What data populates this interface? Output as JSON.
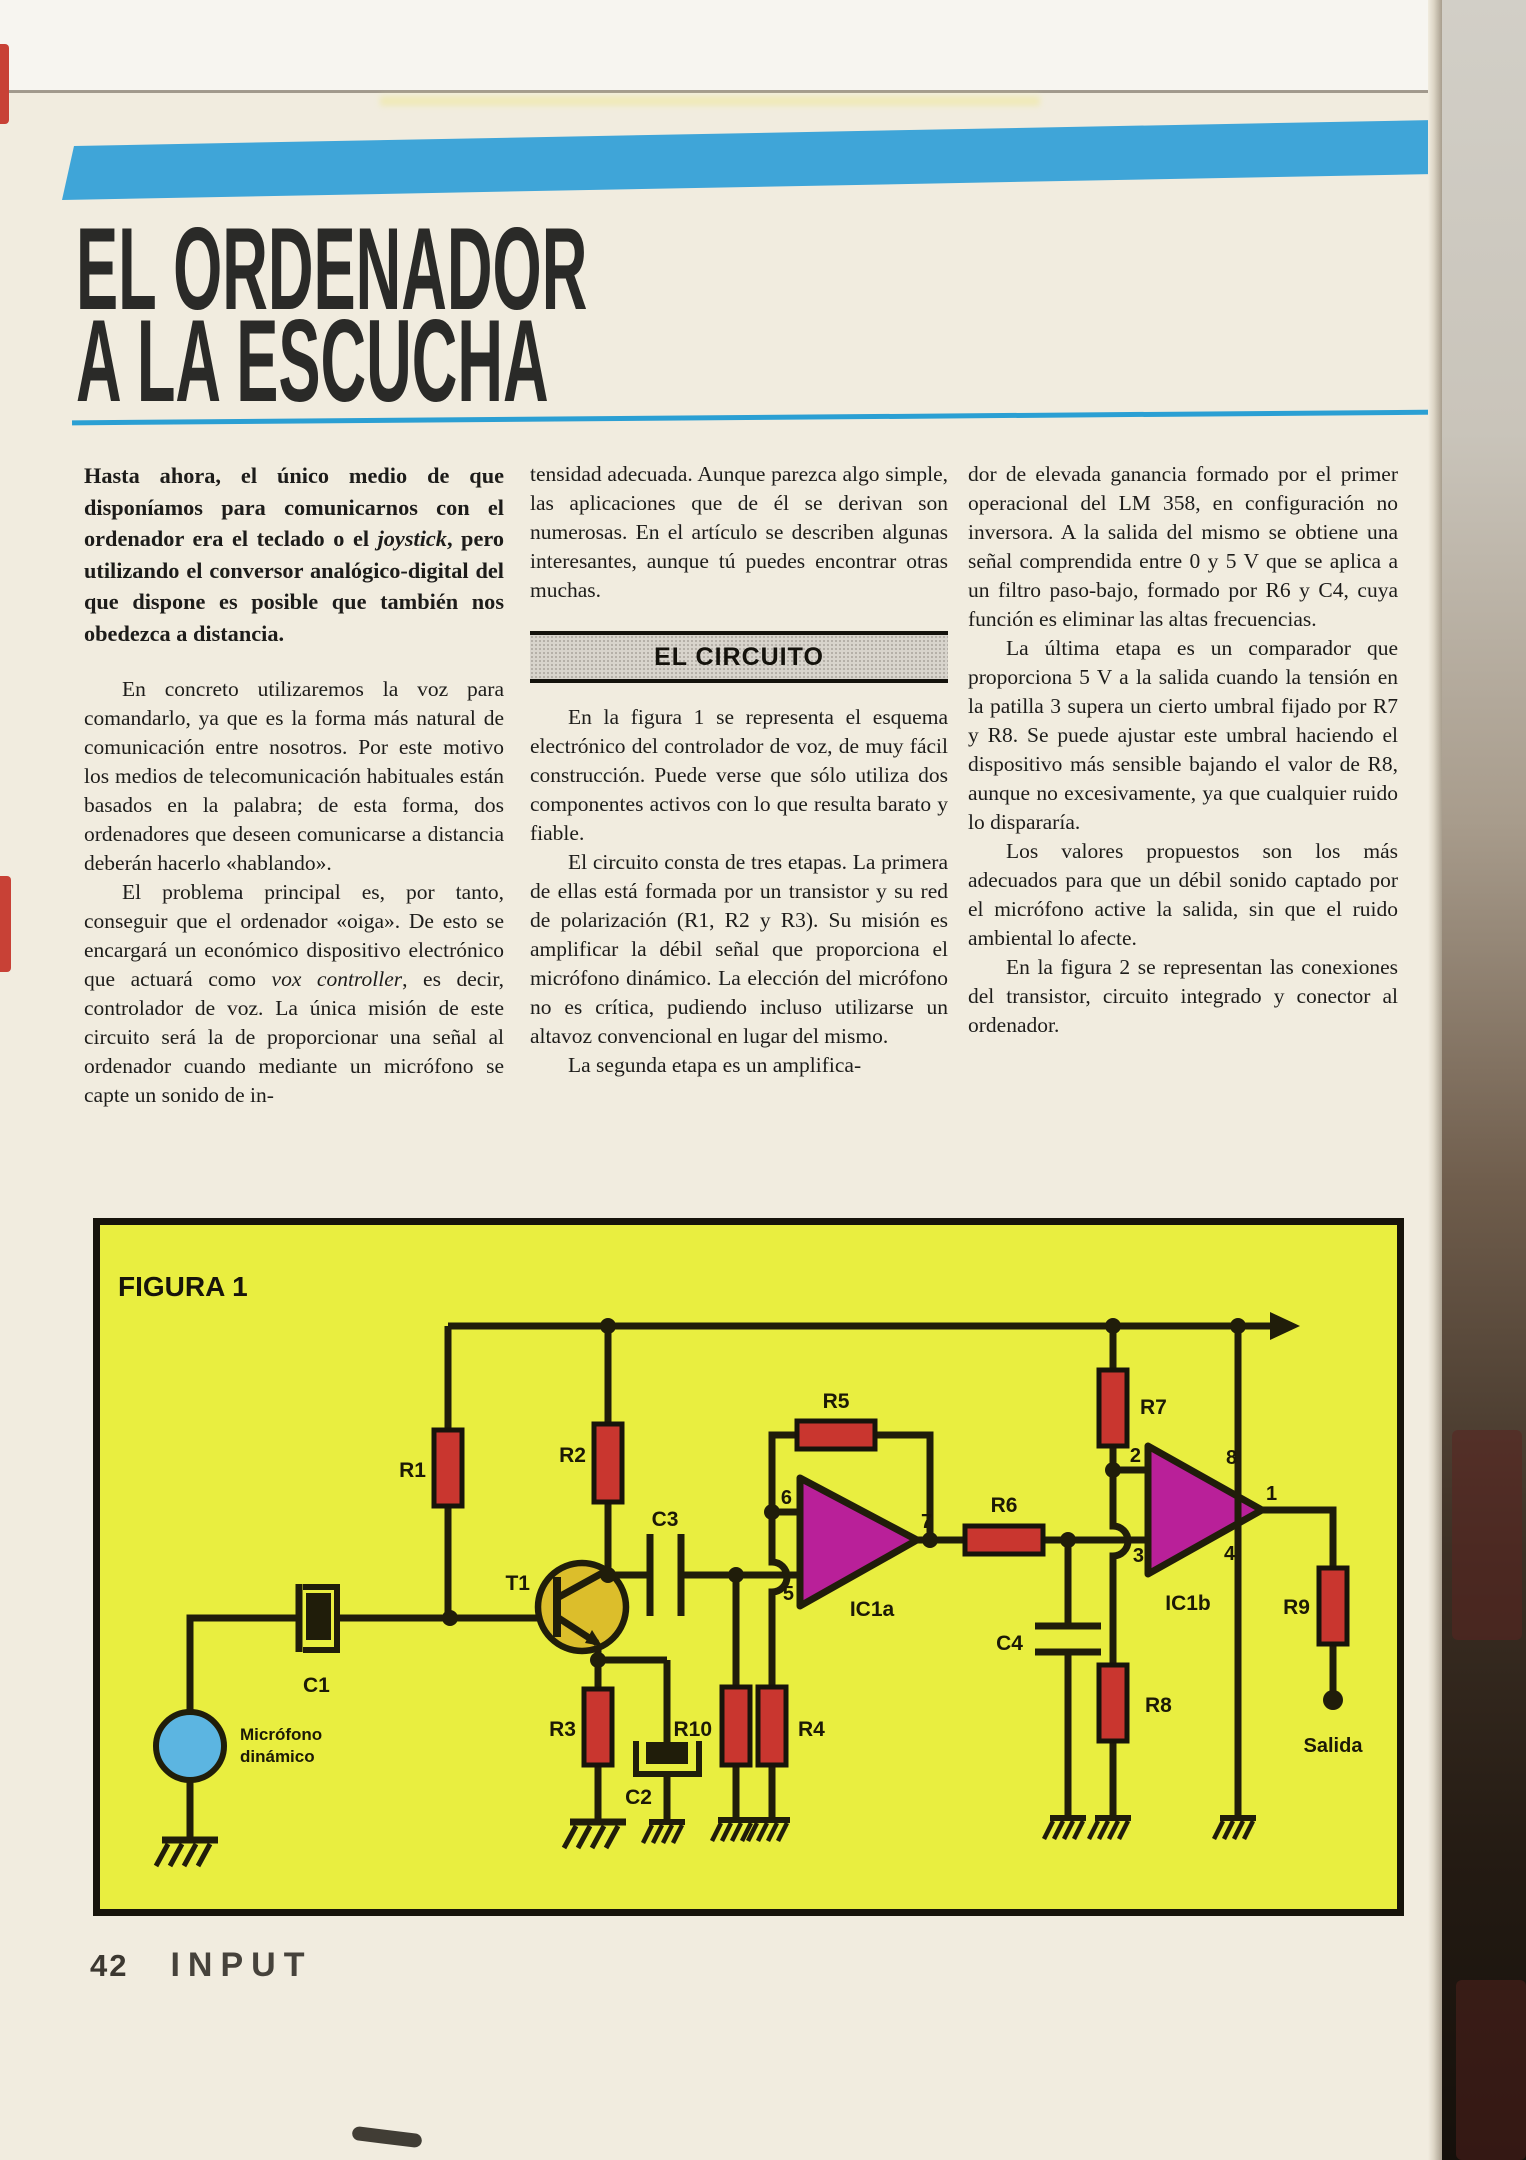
{
  "title": {
    "line1": "EL ORDENADOR",
    "line2": "A LA ESCUCHA"
  },
  "columns": {
    "col1": {
      "intro_pre": "Hasta ahora, el único medio de que disponíamos para comunicarnos con el ordenador era el teclado o el ",
      "intro_em": "joystick",
      "intro_post": ", pero utilizando el conversor analógico-digital del que dispone es posible que también nos obedezca a distancia.",
      "p2": "En concreto utilizaremos la voz para comandarlo, ya que es la forma más natural de comunicación entre nosotros. Por este motivo los medios de telecomunicación habituales están basados en la palabra; de esta forma, dos ordenadores que deseen comunicarse a distancia deberán hacerlo «hablando».",
      "p3_pre": "El problema principal es, por tanto, conseguir que el ordenador «oiga». De esto se encargará un económico dispositivo electrónico que actuará como ",
      "p3_em": "vox controller",
      "p3_post": ", es decir, controlador de voz. La única misión de este circuito será la de proporcionar una señal al ordenador cuando mediante un micrófono se capte un sonido de in-"
    },
    "col2": {
      "p1": "tensidad adecuada. Aunque parezca algo simple, las aplicaciones que de él se derivan son numerosas. En el artículo se describen algunas interesantes, aunque tú puedes encontrar otras muchas.",
      "section_header": "EL CIRCUITO",
      "p2": "En la figura 1 se representa el esquema electrónico del controlador de voz, de muy fácil construcción. Puede verse que sólo utiliza dos componentes activos con lo que resulta barato y fiable.",
      "p3": "El circuito consta de tres etapas. La primera de ellas está formada por un transistor y su red de polarización (R1, R2 y R3). Su misión es amplificar la débil señal que proporciona el micrófono dinámico. La elección del micrófono no es crítica, pudiendo incluso utilizarse un altavoz convencional en lugar del mismo.",
      "p4": "La segunda etapa es un amplifica-"
    },
    "col3": {
      "p1": "dor de elevada ganancia formado por el primer operacional del LM 358, en configuración no inversora. A la salida del mismo se obtiene una señal comprendida entre 0 y 5 V que se aplica a un filtro paso-bajo, formado por R6 y C4, cuya función es eliminar las altas frecuencias.",
      "p2": "La última etapa es un comparador que proporciona 5 V a la salida cuando la tensión en la patilla 3 supera un cierto umbral fijado por R7 y R8. Se puede ajustar este umbral haciendo el dispositivo más sensible bajando el valor de R8, aunque no excesivamente, ya que cualquier ruido lo dispararía.",
      "p3": "Los valores propuestos son los más adecuados para que un débil sonido captado por el micrófono active la salida, sin que el ruido ambiental lo afecte.",
      "p4": "En la figura 2 se representan las conexiones del transistor, circuito integrado y conector al ordenador."
    }
  },
  "figure": {
    "caption": "FIGURA 1",
    "labels": {
      "r1": "R1",
      "r2": "R2",
      "r3": "R3",
      "r4": "R4",
      "r5": "R5",
      "r6": "R6",
      "r7": "R7",
      "r8": "R8",
      "r9": "R9",
      "r10": "R10",
      "c1": "C1",
      "c2": "C2",
      "c3": "C3",
      "c4": "C4",
      "t1": "T1",
      "ic1a": "IC1a",
      "ic1b": "IC1b",
      "mic_line1": "Micrófono",
      "mic_line2": "dinámico",
      "salida": "Salida"
    },
    "pins": {
      "p1": "1",
      "p2": "2",
      "p3": "3",
      "p4": "4",
      "p5": "5",
      "p6": "6",
      "p7": "7",
      "p8": "8"
    }
  },
  "footer": {
    "page_number": "42",
    "magazine": "INPUT"
  },
  "colors": {
    "paper": "#f1ecdf",
    "banner_blue": "#3fa5d8",
    "rule_blue": "#2b9fd3",
    "figure_yellow": "#e9ee40",
    "resistor_red": "#c9362f",
    "opamp_magenta": "#b92099",
    "transistor_yellow": "#dcbe2b",
    "microphone_blue": "#5cb5e1",
    "wire_ink": "#201d0a",
    "band_gray": "#d8d4cc"
  }
}
